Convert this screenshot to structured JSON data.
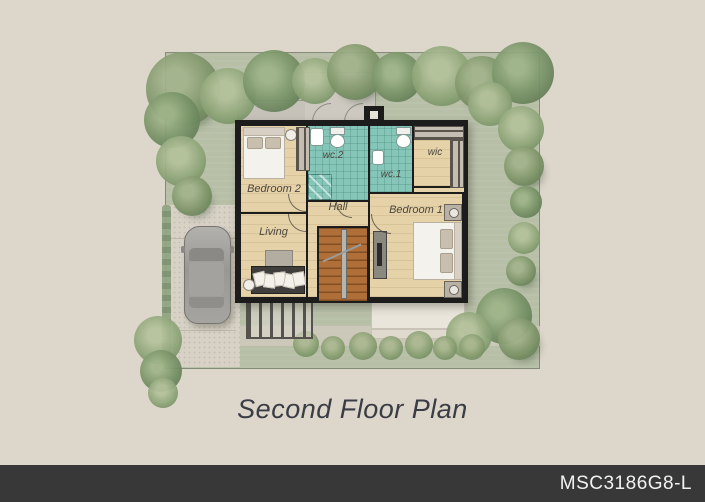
{
  "title": "Second Floor Plan",
  "plan_code": "MSC3186G8-L",
  "rooms": {
    "bedroom2": "Bedroom 2",
    "wc2": "wc.2",
    "wc1": "wc.1",
    "wic": "wic",
    "bedroom1": "Bedroom 1",
    "hall": "Hall",
    "living": "Living"
  },
  "colors": {
    "background": "#ddd6cb",
    "grass": "#b7bfa7",
    "floor_wood": "#e6d2a9",
    "bath_teal": "#85c6b9",
    "wall": "#1c1c1c",
    "stairs": "#b06f38",
    "terrace": "#cdc9c1",
    "pavement": "#d8d2c6",
    "footer_bar": "#383838",
    "footer_text": "#f2f2f2",
    "title_text": "#3a3d44"
  }
}
